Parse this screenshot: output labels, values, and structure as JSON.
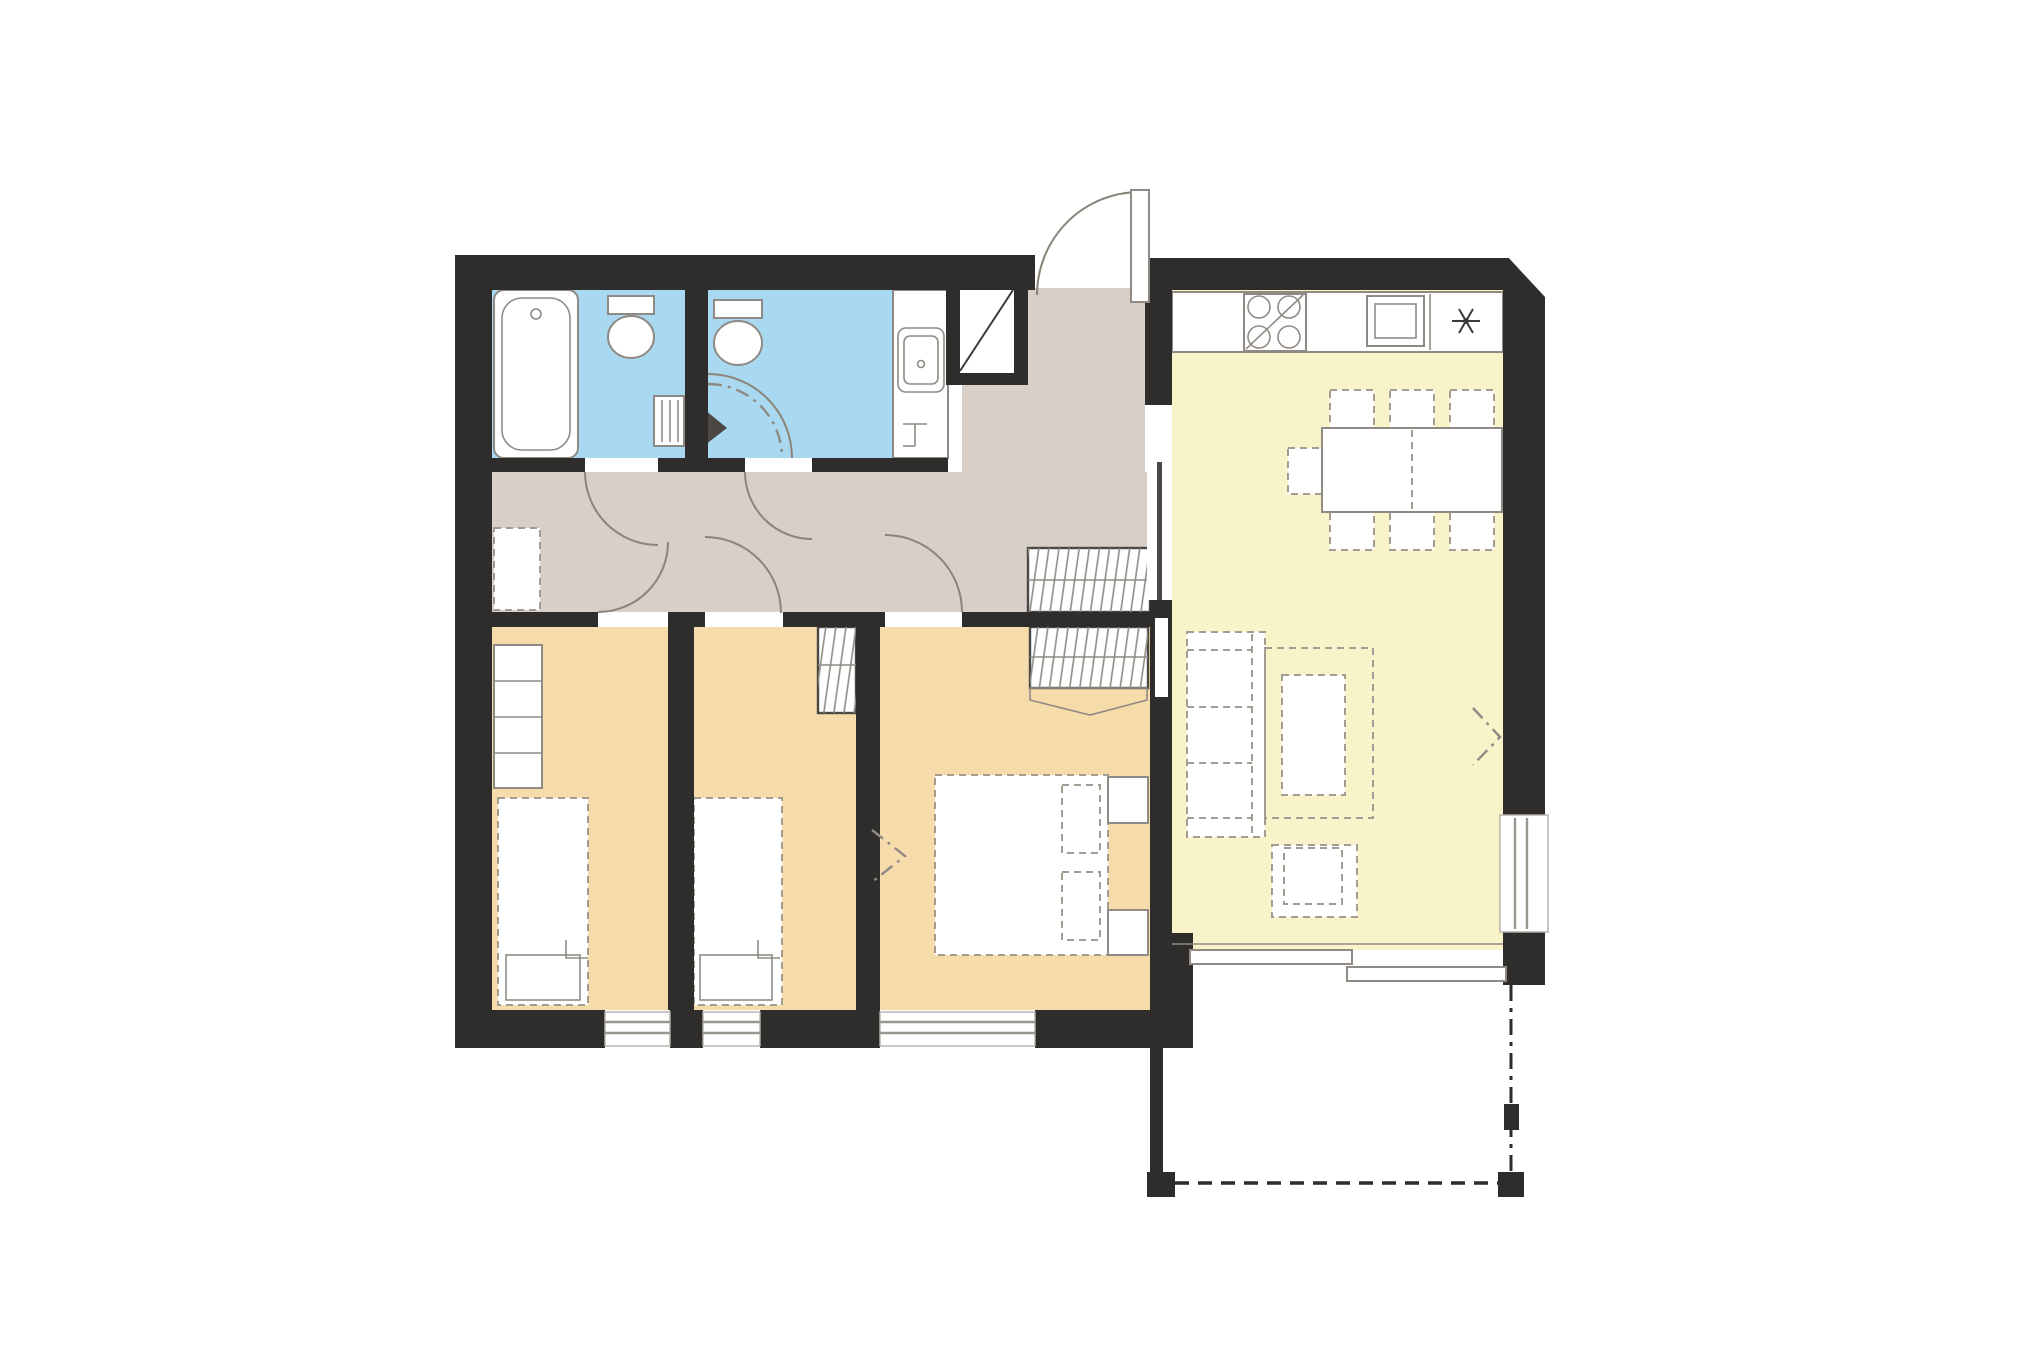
{
  "plan": {
    "canvas": {
      "width": 2043,
      "height": 1365,
      "background": "#ffffff"
    },
    "colors": {
      "wall": "#2f2d2b",
      "hall_floor": "#d8d0c8",
      "bedroom_floor": "#f6dcab",
      "kitchen_floor": "#f9f3c9",
      "bathroom_floor": "#a9d9f0",
      "white": "#ffffff",
      "fixture_stroke": "#8f8b84",
      "furniture_stroke": "#a29c92",
      "dark_line": "#3c3a38"
    },
    "rooms": [
      {
        "id": "bathroom-1",
        "name": "bathroom-with-bathtub",
        "floor_color_key": "bathroom_floor",
        "fixtures": [
          "bathtub",
          "toilet",
          "towel-radiator"
        ]
      },
      {
        "id": "bathroom-2",
        "name": "shower-room",
        "floor_color_key": "bathroom_floor",
        "fixtures": [
          "toilet",
          "corner-shower",
          "washbasin-counter",
          "tap"
        ]
      },
      {
        "id": "hall",
        "name": "entrance-hall",
        "floor_color_key": "hall_floor",
        "fixtures": [
          "entrance-door",
          "coat-closet",
          "storage-niche",
          "installation-shaft",
          "pocket-door"
        ]
      },
      {
        "id": "kitchen-living",
        "name": "kitchen-living-room",
        "floor_color_key": "kitchen_floor",
        "fixtures": [
          "kitchen-counter",
          "hob",
          "oven",
          "fridge",
          "dining-table",
          "dining-chairs-x7",
          "sofa",
          "rug",
          "coffee-table",
          "armchair",
          "window",
          "sliding-terrace-door"
        ]
      },
      {
        "id": "bedroom-1",
        "name": "bedroom-1",
        "floor_color_key": "bedroom_floor",
        "fixtures": [
          "single-bed",
          "wardrobe-shelves",
          "window"
        ]
      },
      {
        "id": "bedroom-2",
        "name": "bedroom-2",
        "floor_color_key": "bedroom_floor",
        "fixtures": [
          "single-bed",
          "wardrobe-rail",
          "window"
        ]
      },
      {
        "id": "bedroom-3",
        "name": "master-bedroom",
        "floor_color_key": "bedroom_floor",
        "fixtures": [
          "double-bed",
          "nightstand",
          "nightstand",
          "wardrobe-rail",
          "window"
        ]
      },
      {
        "id": "terrace",
        "name": "terrace",
        "floor_color_key": "white",
        "fixtures": [
          "corner-posts",
          "dashed-boundary"
        ]
      }
    ]
  }
}
